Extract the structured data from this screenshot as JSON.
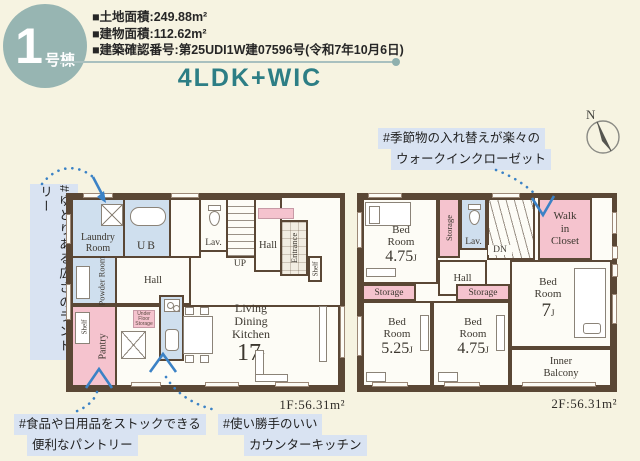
{
  "header": {
    "badge": {
      "number": "1",
      "suffix": "号棟"
    },
    "info_lines": [
      "■土地面積:249.88m²",
      "■建物面積:112.62m²",
      "■建築確認番号:第25UDI1W建07596号(令和7年10月6日)"
    ],
    "title": "4LDK+WIC"
  },
  "compass": {
    "label": "N"
  },
  "annotations": {
    "laundry": "#ゆとりある広さのランドリー",
    "wic": [
      "#季節物の入れ替えが楽々の",
      "ウォークインクローゼット"
    ],
    "pantry": [
      "#食品や日用品をストックできる",
      "便利なパントリー"
    ],
    "kitchen": [
      "#使い勝手のいい",
      "カウンターキッチン"
    ]
  },
  "floor1": {
    "area_label": "1F:56.31m²",
    "rooms": {
      "laundry": [
        "Laundry",
        "Room"
      ],
      "ub": "UB",
      "lav": "Lav.",
      "stairs": "UP",
      "hall_upper": "Hall",
      "entrance": "Entrance",
      "shelf_right": "Shelf",
      "powder": "Powder Room",
      "hall": "Hall",
      "shelf_left": "Shelf",
      "pantry": "Pantry",
      "under_floor": [
        "Under",
        "Floor",
        "Storage"
      ],
      "ldk": {
        "lines": [
          "Living",
          "Dining",
          "Kitchen"
        ],
        "size": "17",
        "unit": "J"
      }
    }
  },
  "floor2": {
    "area_label": "2F:56.31m²",
    "rooms": {
      "bed1": {
        "name": [
          "Bed",
          "Room"
        ],
        "size": "4.75",
        "unit": "J"
      },
      "bed2": {
        "name": [
          "Bed",
          "Room"
        ],
        "size": "5.25",
        "unit": "J"
      },
      "bed3": {
        "name": [
          "Bed",
          "Room"
        ],
        "size": "4.75",
        "unit": "J"
      },
      "bed4": {
        "name": [
          "Bed",
          "Room"
        ],
        "size": "7",
        "unit": "J"
      },
      "storage_v": "Storage",
      "storage_left": "Storage",
      "storage_mid": "Storage",
      "lav": "Lav.",
      "stairs": "DN",
      "hall": "Hall",
      "wic": [
        "Walk",
        "in",
        "Closet"
      ],
      "balcony": [
        "Inner",
        "Balcony"
      ]
    }
  },
  "colors": {
    "accent_teal": "#2d7e85",
    "badge_teal": "#97b5b2",
    "wall_brown": "#5a4735",
    "room_blue": "#cfdfee",
    "room_pink": "#f5c3ce",
    "note_highlight": "#d9e3f2",
    "connector_blue": "#3b82c6",
    "background_cream": "#f6f3e1"
  }
}
